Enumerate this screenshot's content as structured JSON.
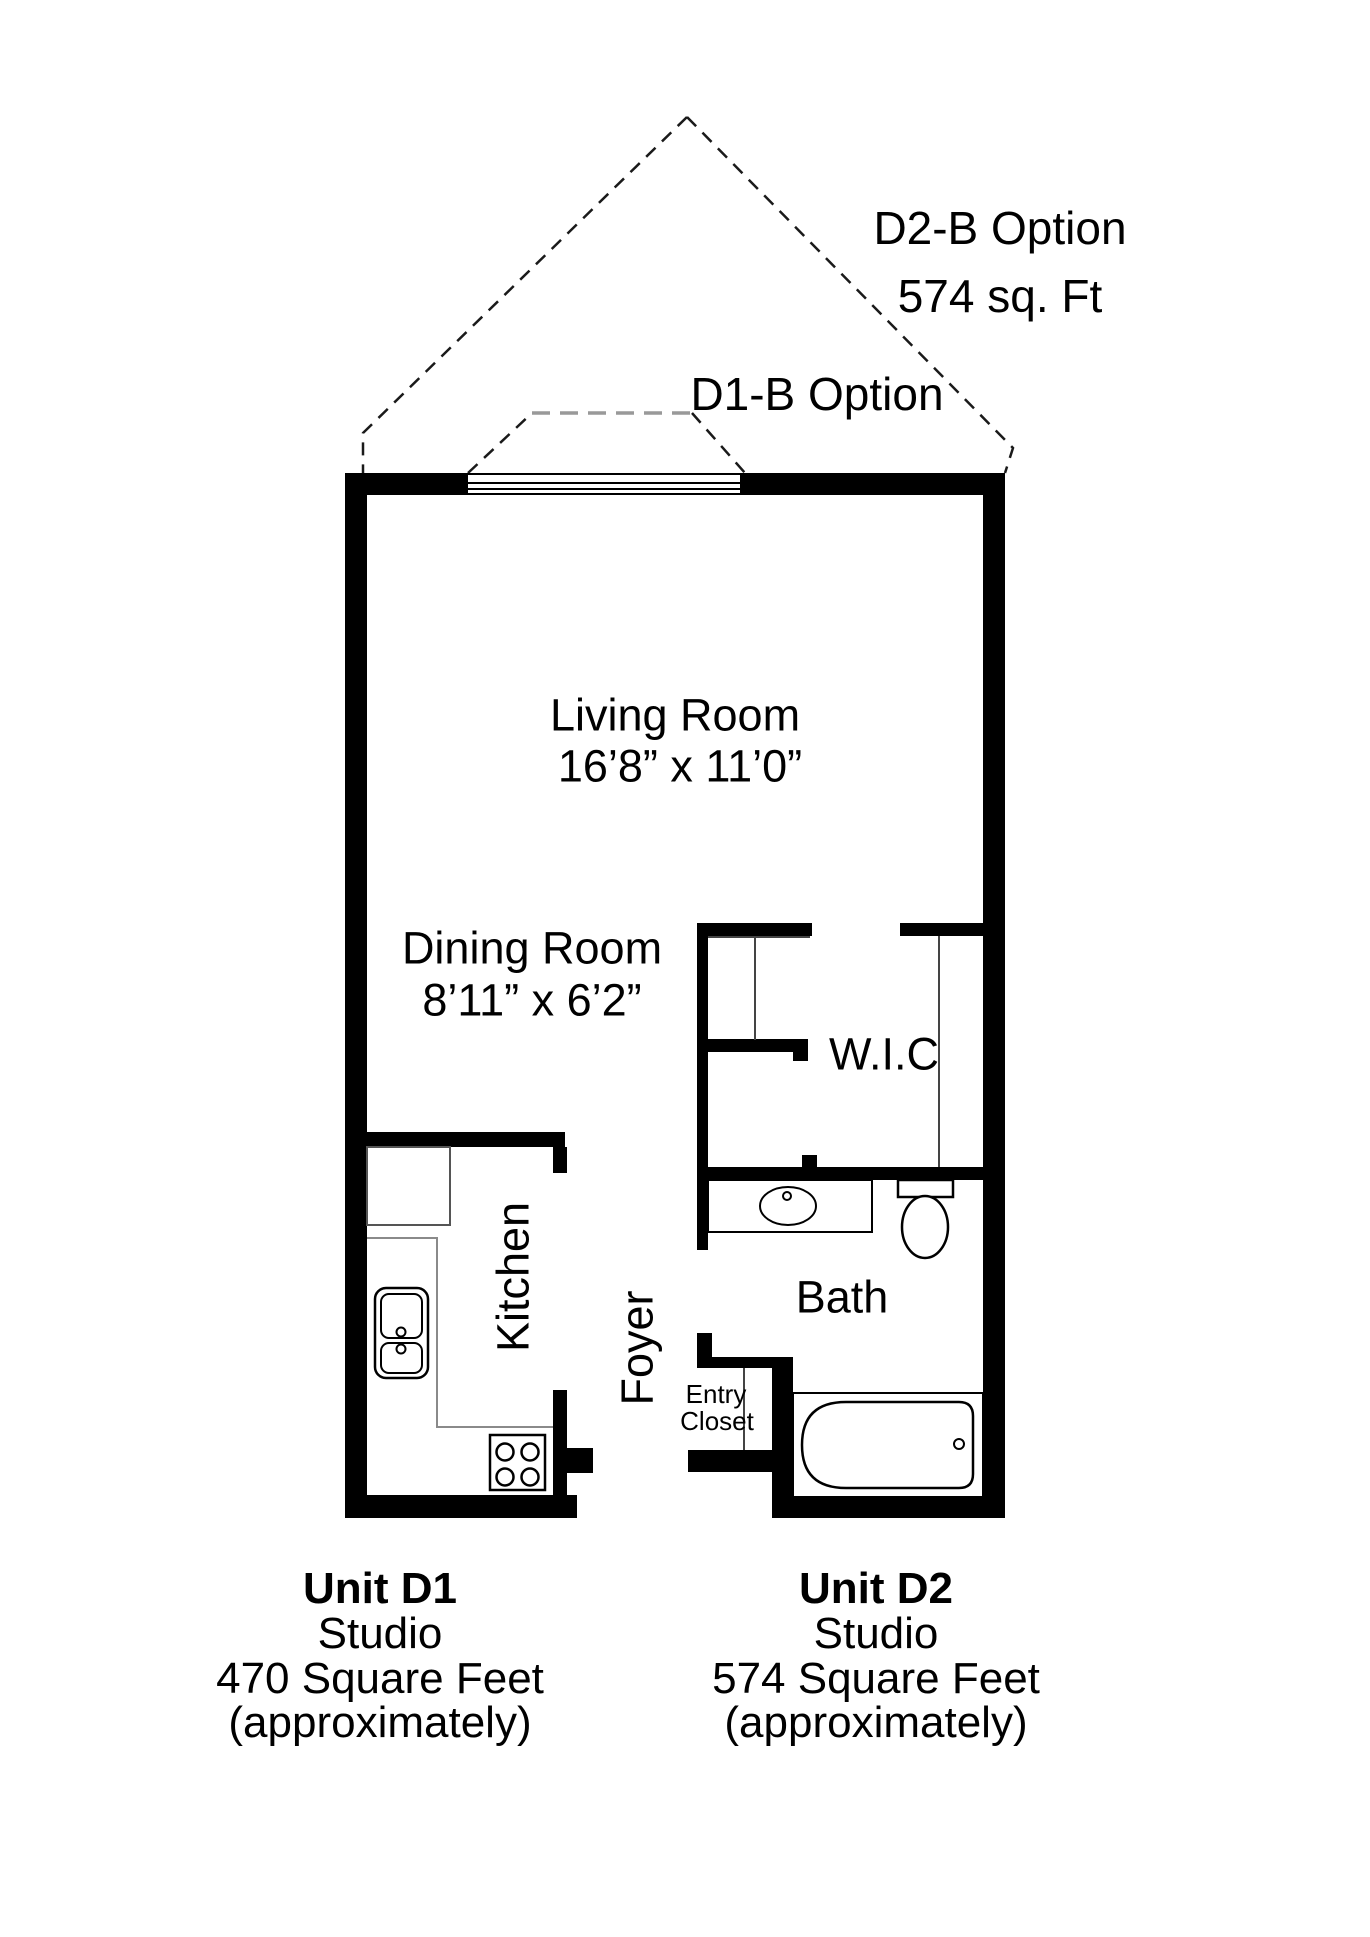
{
  "page": {
    "background": "#ffffff",
    "line_color": "#000000",
    "counter_line_color": "#888888",
    "dashed_line_color": "#1a1a1a"
  },
  "options": {
    "d2b": {
      "line1": "D2-B Option",
      "line2": "574 sq. Ft"
    },
    "d1b": {
      "label": "D1-B Option"
    }
  },
  "rooms": {
    "living": {
      "name": "Living Room",
      "dims": "16’8” x 11’0”"
    },
    "dining": {
      "name": "Dining Room",
      "dims": "8’11” x 6’2”"
    },
    "wic": {
      "name": "W.I.C"
    },
    "bath": {
      "name": "Bath"
    },
    "kitchen": {
      "name": "Kitchen"
    },
    "foyer": {
      "name": "Foyer"
    },
    "entry_closet": {
      "line1": "Entry",
      "line2": "Closet"
    }
  },
  "units": {
    "d1": {
      "title": "Unit D1",
      "type": "Studio",
      "area": "470 Square Feet",
      "note": "(approximately)"
    },
    "d2": {
      "title": "Unit D2",
      "type": "Studio",
      "area": "574 Square Feet",
      "note": "(approximately)"
    }
  }
}
